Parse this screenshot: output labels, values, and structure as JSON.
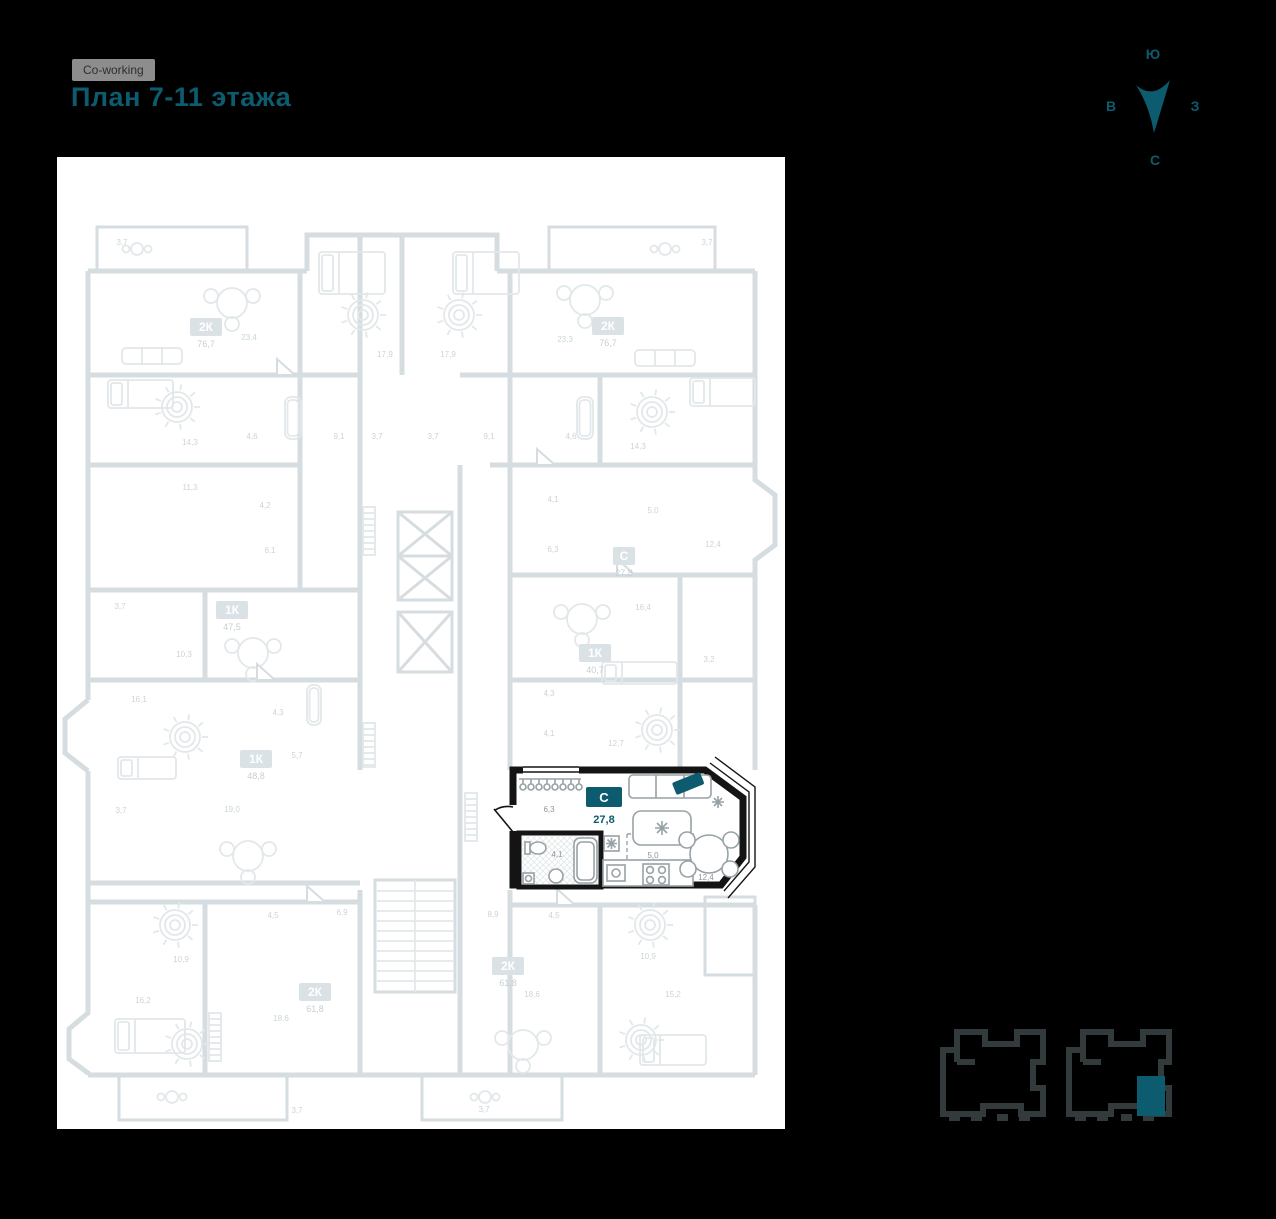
{
  "theme": {
    "accent": "#0d5b6e",
    "highlight_wall": "#141414",
    "chip_bg": "#8d8d8d",
    "plan_line_color": "#d6dde0",
    "room_label_color": "#cbd4d8"
  },
  "header": {
    "project_badge": "Co-working",
    "title": "План 7-11 этажа"
  },
  "compass": {
    "top": "Ю",
    "left": "В",
    "right": "З",
    "bottom": "С"
  },
  "floor_plan": {
    "selected_unit": {
      "type_label": "С",
      "area_value": "27,8",
      "rooms": [
        {
          "name": "hallway",
          "area": "6,3",
          "x": 492,
          "y": 655
        },
        {
          "name": "bathroom",
          "area": "4,1",
          "x": 500,
          "y": 700
        },
        {
          "name": "kitchen",
          "area": "5,0",
          "x": 596,
          "y": 701
        },
        {
          "name": "living",
          "area": "12,4",
          "x": 649,
          "y": 723
        }
      ]
    },
    "units": [
      {
        "type": "2К",
        "area": "76,7",
        "x": 149,
        "y": 170
      },
      {
        "type": "2К",
        "area": "76,7",
        "x": 551,
        "y": 169
      },
      {
        "type": "С",
        "area": "27,8",
        "x": 567,
        "y": 399
      },
      {
        "type": "1К",
        "area": "40,7",
        "x": 538,
        "y": 496
      },
      {
        "type": "1К",
        "area": "47,5",
        "x": 175,
        "y": 453
      },
      {
        "type": "1К",
        "area": "48,8",
        "x": 199,
        "y": 602
      },
      {
        "type": "2К",
        "area": "61,8",
        "x": 258,
        "y": 835
      },
      {
        "type": "2К",
        "area": "61,8",
        "x": 451,
        "y": 809
      }
    ],
    "room_labels": [
      {
        "t": "3,7",
        "x": 65,
        "y": 88
      },
      {
        "t": "3,7",
        "x": 650,
        "y": 88
      },
      {
        "t": "23,4",
        "x": 192,
        "y": 183
      },
      {
        "t": "23,3",
        "x": 508,
        "y": 185
      },
      {
        "t": "17,9",
        "x": 328,
        "y": 200
      },
      {
        "t": "17,9",
        "x": 391,
        "y": 200
      },
      {
        "t": "14,3",
        "x": 133,
        "y": 288
      },
      {
        "t": "4,6",
        "x": 195,
        "y": 282
      },
      {
        "t": "9,1",
        "x": 282,
        "y": 282
      },
      {
        "t": "3,7",
        "x": 320,
        "y": 282
      },
      {
        "t": "3,7",
        "x": 376,
        "y": 282
      },
      {
        "t": "9,1",
        "x": 432,
        "y": 282
      },
      {
        "t": "4,6",
        "x": 514,
        "y": 282
      },
      {
        "t": "14,3",
        "x": 581,
        "y": 292
      },
      {
        "t": "11,3",
        "x": 133,
        "y": 333
      },
      {
        "t": "4,2",
        "x": 208,
        "y": 351
      },
      {
        "t": "6,1",
        "x": 213,
        "y": 396
      },
      {
        "t": "4,1",
        "x": 496,
        "y": 345
      },
      {
        "t": "5,0",
        "x": 596,
        "y": 356
      },
      {
        "t": "12,4",
        "x": 656,
        "y": 390
      },
      {
        "t": "6,3",
        "x": 496,
        "y": 395
      },
      {
        "t": "3,7",
        "x": 63,
        "y": 452
      },
      {
        "t": "10,3",
        "x": 127,
        "y": 500
      },
      {
        "t": "16,4",
        "x": 586,
        "y": 453
      },
      {
        "t": "3,2",
        "x": 652,
        "y": 505
      },
      {
        "t": "4,3",
        "x": 492,
        "y": 539
      },
      {
        "t": "4,1",
        "x": 492,
        "y": 579
      },
      {
        "t": "12,7",
        "x": 559,
        "y": 589
      },
      {
        "t": "16,1",
        "x": 82,
        "y": 545
      },
      {
        "t": "4,3",
        "x": 221,
        "y": 558
      },
      {
        "t": "5,7",
        "x": 240,
        "y": 601
      },
      {
        "t": "3,7",
        "x": 64,
        "y": 656
      },
      {
        "t": "19,0",
        "x": 175,
        "y": 655
      },
      {
        "t": "4,5",
        "x": 216,
        "y": 761
      },
      {
        "t": "6,9",
        "x": 285,
        "y": 758
      },
      {
        "t": "10,9",
        "x": 124,
        "y": 805
      },
      {
        "t": "16,2",
        "x": 86,
        "y": 846
      },
      {
        "t": "18,6",
        "x": 224,
        "y": 864
      },
      {
        "t": "3,7",
        "x": 240,
        "y": 956
      },
      {
        "t": "8,9",
        "x": 436,
        "y": 760
      },
      {
        "t": "4,5",
        "x": 497,
        "y": 761
      },
      {
        "t": "10,9",
        "x": 591,
        "y": 802
      },
      {
        "t": "18,6",
        "x": 475,
        "y": 840
      },
      {
        "t": "15,2",
        "x": 616,
        "y": 840
      },
      {
        "t": "3,7",
        "x": 427,
        "y": 955
      }
    ]
  }
}
